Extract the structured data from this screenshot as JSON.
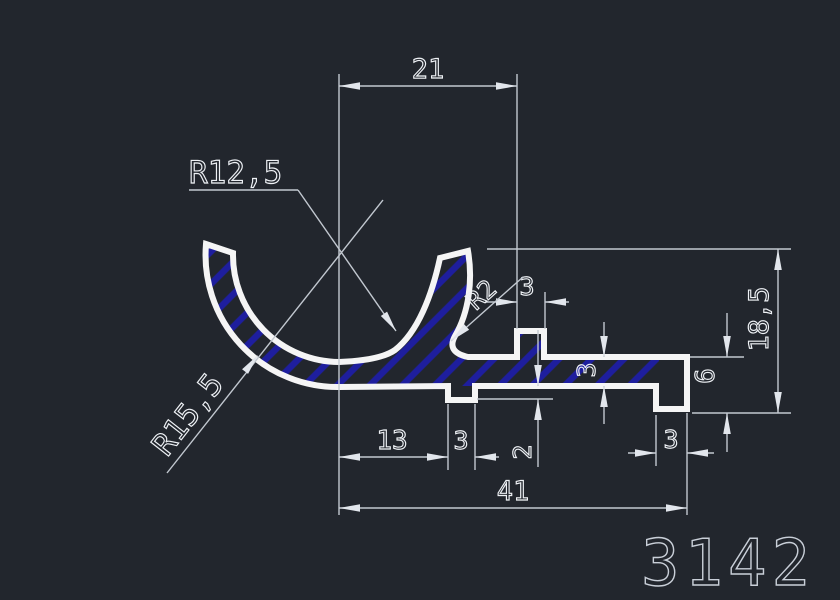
{
  "drawing": {
    "part_number": "3142",
    "colors": {
      "background": "#22262d",
      "profile_outline": "#f5f5f5",
      "hatch_blue": "#1e1e9e",
      "dimension_lines": "#c2c8d0",
      "dimension_text": "#eef1f5",
      "part_number_text": "#c9cfd8"
    },
    "dimensions": {
      "top_width": "21",
      "tab_width": "3",
      "radius_inner": "R12,5",
      "radius_outer": "R15,5",
      "radius_hook": "R2",
      "overall_height": "18,5",
      "right_end_height": "6",
      "strip_thickness": "3",
      "rib_depth": "2",
      "left_flat_length": "13",
      "rib_width": "3",
      "foot_width": "3",
      "overall_width": "41"
    }
  }
}
